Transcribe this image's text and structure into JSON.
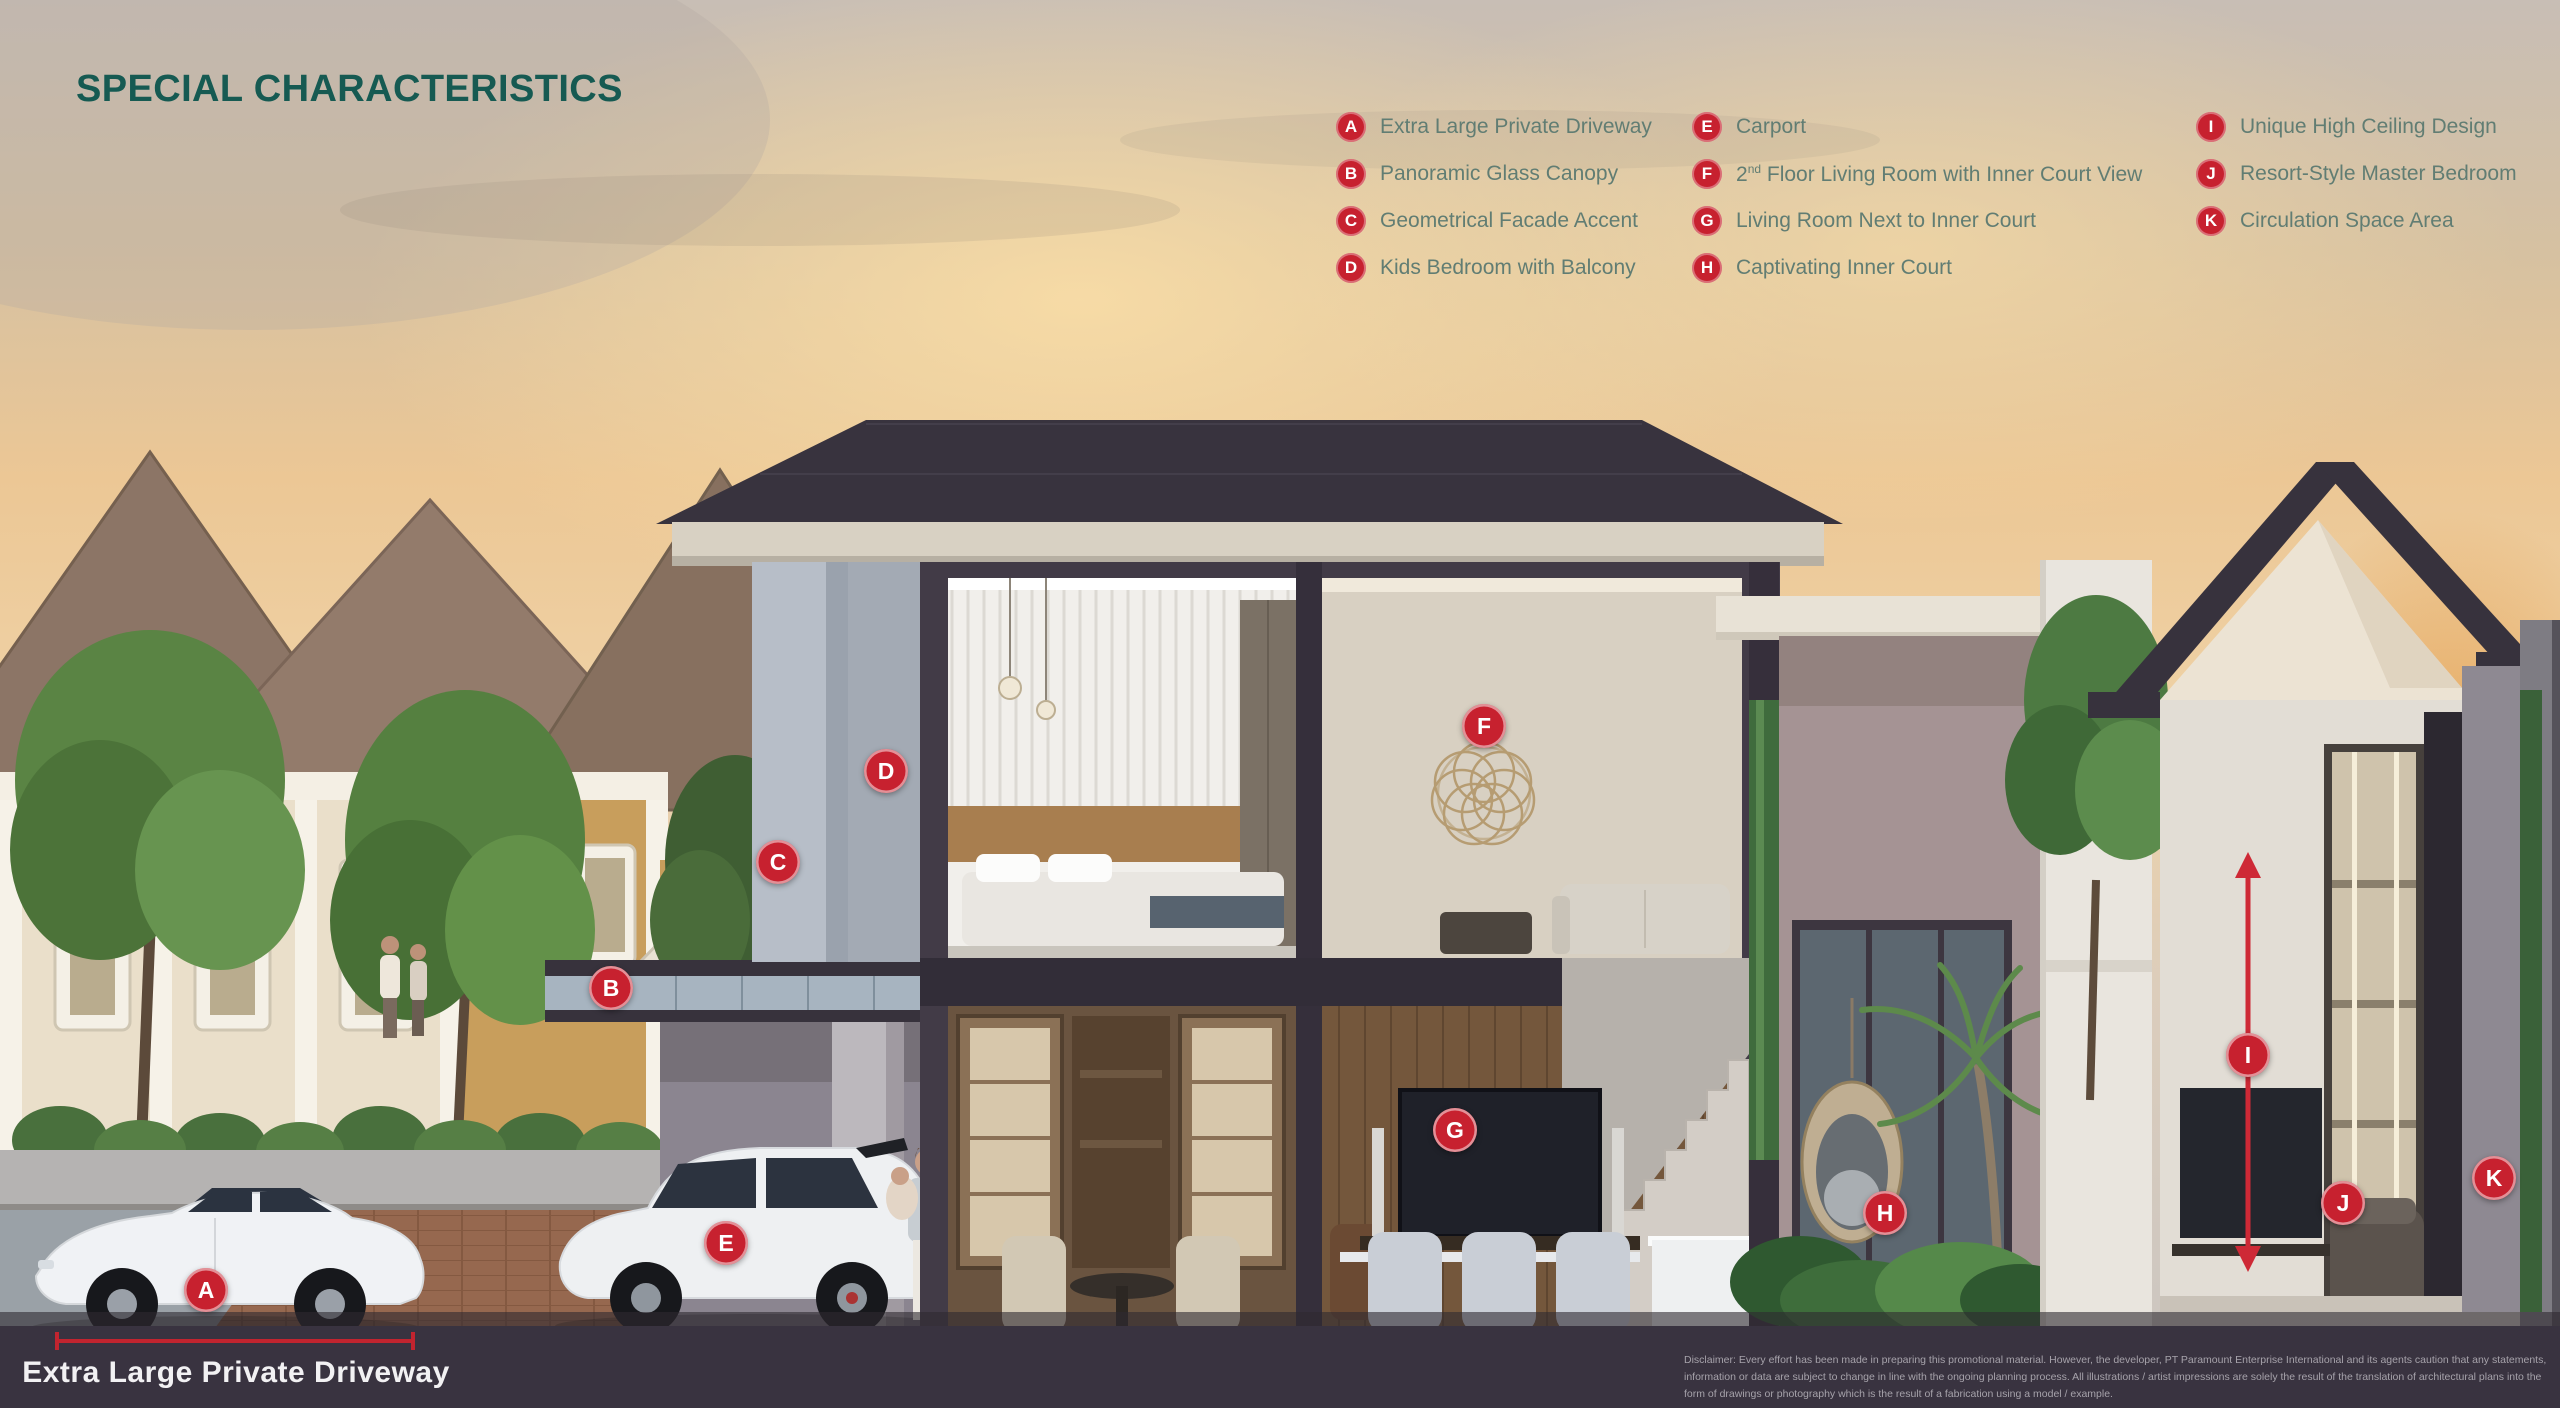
{
  "title": "SPECIAL CHARACTERISTICS",
  "colors": {
    "accent_red": "#c7212f",
    "title_teal": "#165a52",
    "legend_text": "#617d73",
    "bottom_band": "#393340"
  },
  "legend": {
    "col1": [
      {
        "letter": "A",
        "label": "Extra Large Private Driveway"
      },
      {
        "letter": "B",
        "label": "Panoramic Glass Canopy"
      },
      {
        "letter": "C",
        "label": "Geometrical Facade Accent"
      },
      {
        "letter": "D",
        "label": "Kids Bedroom with Balcony"
      }
    ],
    "col2": [
      {
        "letter": "E",
        "label": "Carport"
      },
      {
        "letter": "F",
        "label_pre": "2",
        "label_sup": "nd",
        "label_post": " Floor Living Room with Inner Court View"
      },
      {
        "letter": "G",
        "label": "Living Room Next to Inner Court"
      },
      {
        "letter": "H",
        "label": "Captivating Inner Court"
      }
    ],
    "col3": [
      {
        "letter": "I",
        "label": "Unique High Ceiling Design"
      },
      {
        "letter": "J",
        "label": "Resort-Style Master Bedroom"
      },
      {
        "letter": "K",
        "label": "Circulation Space Area"
      }
    ]
  },
  "markers": {
    "a": "A",
    "b": "B",
    "c": "C",
    "d": "D",
    "e": "E",
    "f": "F",
    "g": "G",
    "h": "H",
    "i": "I",
    "j": "J",
    "k": "K"
  },
  "callout": {
    "label": "Extra Large Private Driveway"
  },
  "disclaimer": "Disclaimer: Every effort has been made in preparing this promotional material. However, the developer, PT Paramount Enterprise International and its agents caution that any statements, information or data are subject to change in line with the ongoing planning process. All illustrations / artist impressions are solely the result of the translation of architectural plans into the form of drawings or photography which is the result of a fabrication using a model / example."
}
